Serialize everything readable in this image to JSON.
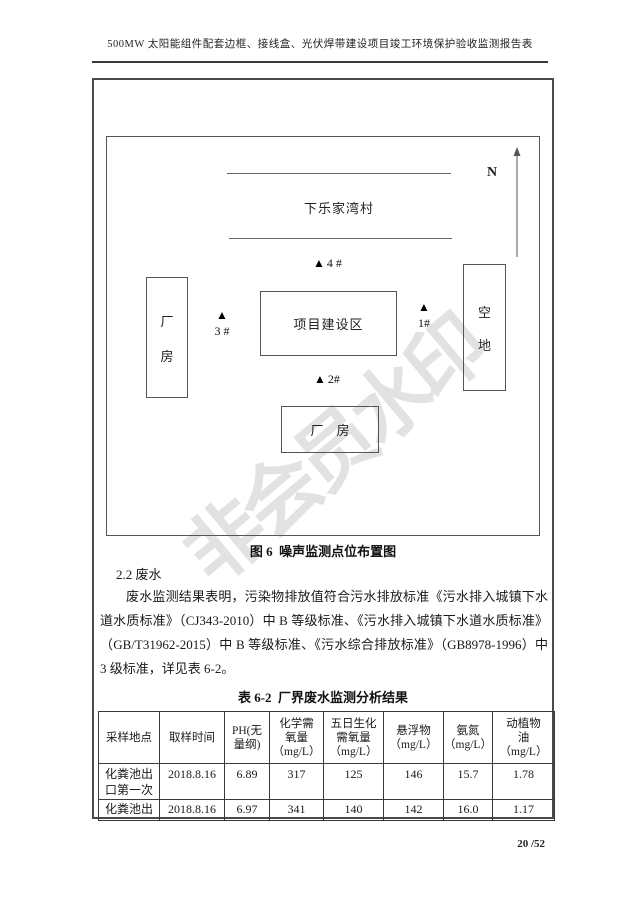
{
  "header": {
    "title": "500MW 太阳能组件配套边框、接线盒、光伏焊带建设项目竣工环境保护验收监测报告表"
  },
  "watermark": "非会员水印",
  "diagram": {
    "north_label": "N",
    "village_name": "下乐家湾村",
    "left_building": "厂房",
    "center_area": "项目建设区",
    "right_area": "空地",
    "bottom_building": "厂　房",
    "points": {
      "p1": {
        "marker": "▲",
        "label": "1#"
      },
      "p2": {
        "marker": "▲",
        "label": "2#"
      },
      "p3": {
        "marker": "▲",
        "label": "3 #"
      },
      "p4": {
        "marker": "▲",
        "label": "4 #"
      }
    },
    "caption": "图 6  噪声监测点位布置图"
  },
  "section": {
    "heading": "2.2 废水",
    "paragraph": "废水监测结果表明，污染物排放值符合污水排放标准《污水排入城镇下水道水质标准》（CJ343-2010）中 B 等级标准、《污水排入城镇下水道水质标准》（GB/T31962-2015）中 B 等级标准、《污水综合排放标准》（GB8978-1996）中 3 级标准，详见表 6-2。"
  },
  "table": {
    "caption": "表 6-2  厂界废水监测分析结果",
    "headers": [
      "采样地点",
      "取样时间",
      "PH(无\n量纲)",
      "化学需\n氧量\n（mg/L）",
      "五日生化\n需氧量\n（mg/L）",
      "悬浮物\n（mg/L）",
      "氨氮\n（mg/L）",
      "动植物\n油\n（mg/L）"
    ],
    "rows": [
      [
        "化粪池出\n口第一次",
        "2018.8.16",
        "6.89",
        "317",
        "125",
        "146",
        "15.7",
        "1.78"
      ],
      [
        "化粪池出",
        "2018.8.16",
        "6.97",
        "341",
        "140",
        "142",
        "16.0",
        "1.17"
      ]
    ]
  },
  "footer": {
    "page": "20",
    "total": "/52"
  }
}
